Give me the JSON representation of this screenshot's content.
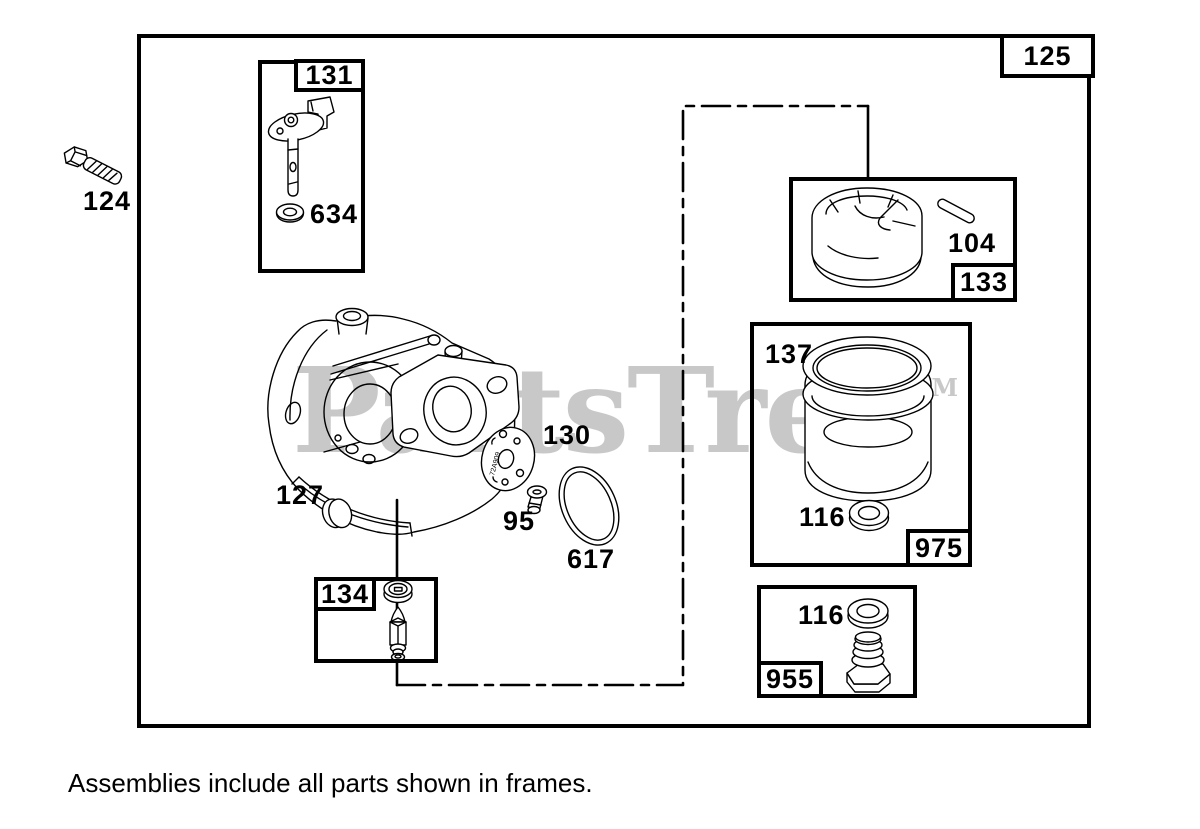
{
  "caption": "Assemblies include all parts shown in frames.",
  "watermark": {
    "text": "PartsTree",
    "tm": "TM",
    "color": "#c8c8c8"
  },
  "labels": {
    "bolt": "124",
    "main_assembly": "125",
    "throttle_shaft_box": "131",
    "throttle_washer": "634",
    "float_pin": "104",
    "float_box": "133",
    "bowl_gasket": "137",
    "carb_gasket": "130",
    "welch_plug": "127",
    "screw": "95",
    "oring": "617",
    "bowl_washer": "116",
    "bowl_box": "975",
    "drain_washer": "116",
    "drain_box": "955",
    "needle_valve_box": "134"
  },
  "gasket_stamp": "72A909"
}
